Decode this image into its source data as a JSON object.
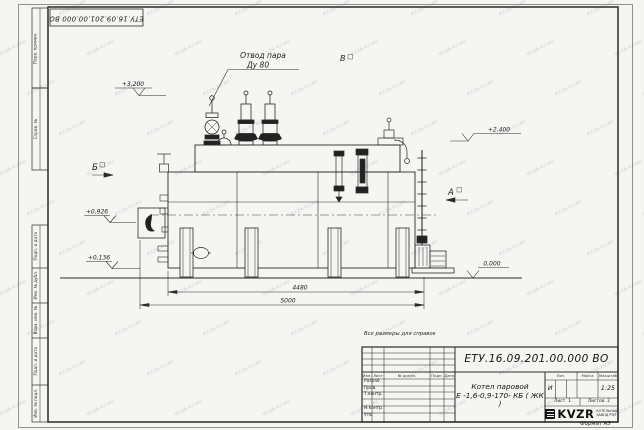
{
  "watermark": {
    "text": "KVZR-KV.RU"
  },
  "stamp_top": "ЕТУ.16.09.201.00.000  ВО",
  "side_labels": {
    "perv": "Перв. примен.",
    "sprav": "Справ. №",
    "podp1": "Подп. и дата",
    "inv_dubl": "Инв. № дубл.",
    "vzam": "Взам. инв. №",
    "podp2": "Подп. и дата",
    "inv_podl": "Инв. № подл."
  },
  "annotations": {
    "steam_outlet_1": "Отвод пара",
    "steam_outlet_2": "Ду 80",
    "elev_3200": "+3,200",
    "elev_2400": "+2,400",
    "elev_0926": "+0,926",
    "elev_0136": "+0,136",
    "elev_0000": "0,000",
    "view_a": "А",
    "view_b": "Б",
    "view_v": "В",
    "dim_4480": "4480",
    "dim_5000": "5000"
  },
  "title_block": {
    "ref_note": "Все размеры для справок",
    "doc_number": "ЕТУ.16.09.201.00.000  ВО",
    "product_line1": "Котел паровой",
    "product_line2": "Е -1,6-0,9-170- КБ ( ЖК )",
    "col_izm": "Изм.",
    "col_list": "Лист",
    "col_docum": "№ докум.",
    "col_podp": "Подп.",
    "col_data": "Дата",
    "row_razrab": "Разраб.",
    "row_prov": "Пров.",
    "row_tkontr": "Т.контр.",
    "row_nkontr": "Н.контр.",
    "row_utv": "Утв.",
    "lit_label": "Лит.",
    "mass_label": "Масса",
    "scale_label": "Масштаб",
    "lit_value": "И",
    "scale_value": "1:25",
    "sheet_label": "Лист",
    "sheet_value": "1",
    "sheets_label": "Листов",
    "sheets_value": "2",
    "logo_word": "KVZR",
    "logo_sub1": "КОТЕЛЬНЫЙ",
    "logo_sub2": "ЗАВОД РЭП",
    "format_label": "Формат А3"
  }
}
